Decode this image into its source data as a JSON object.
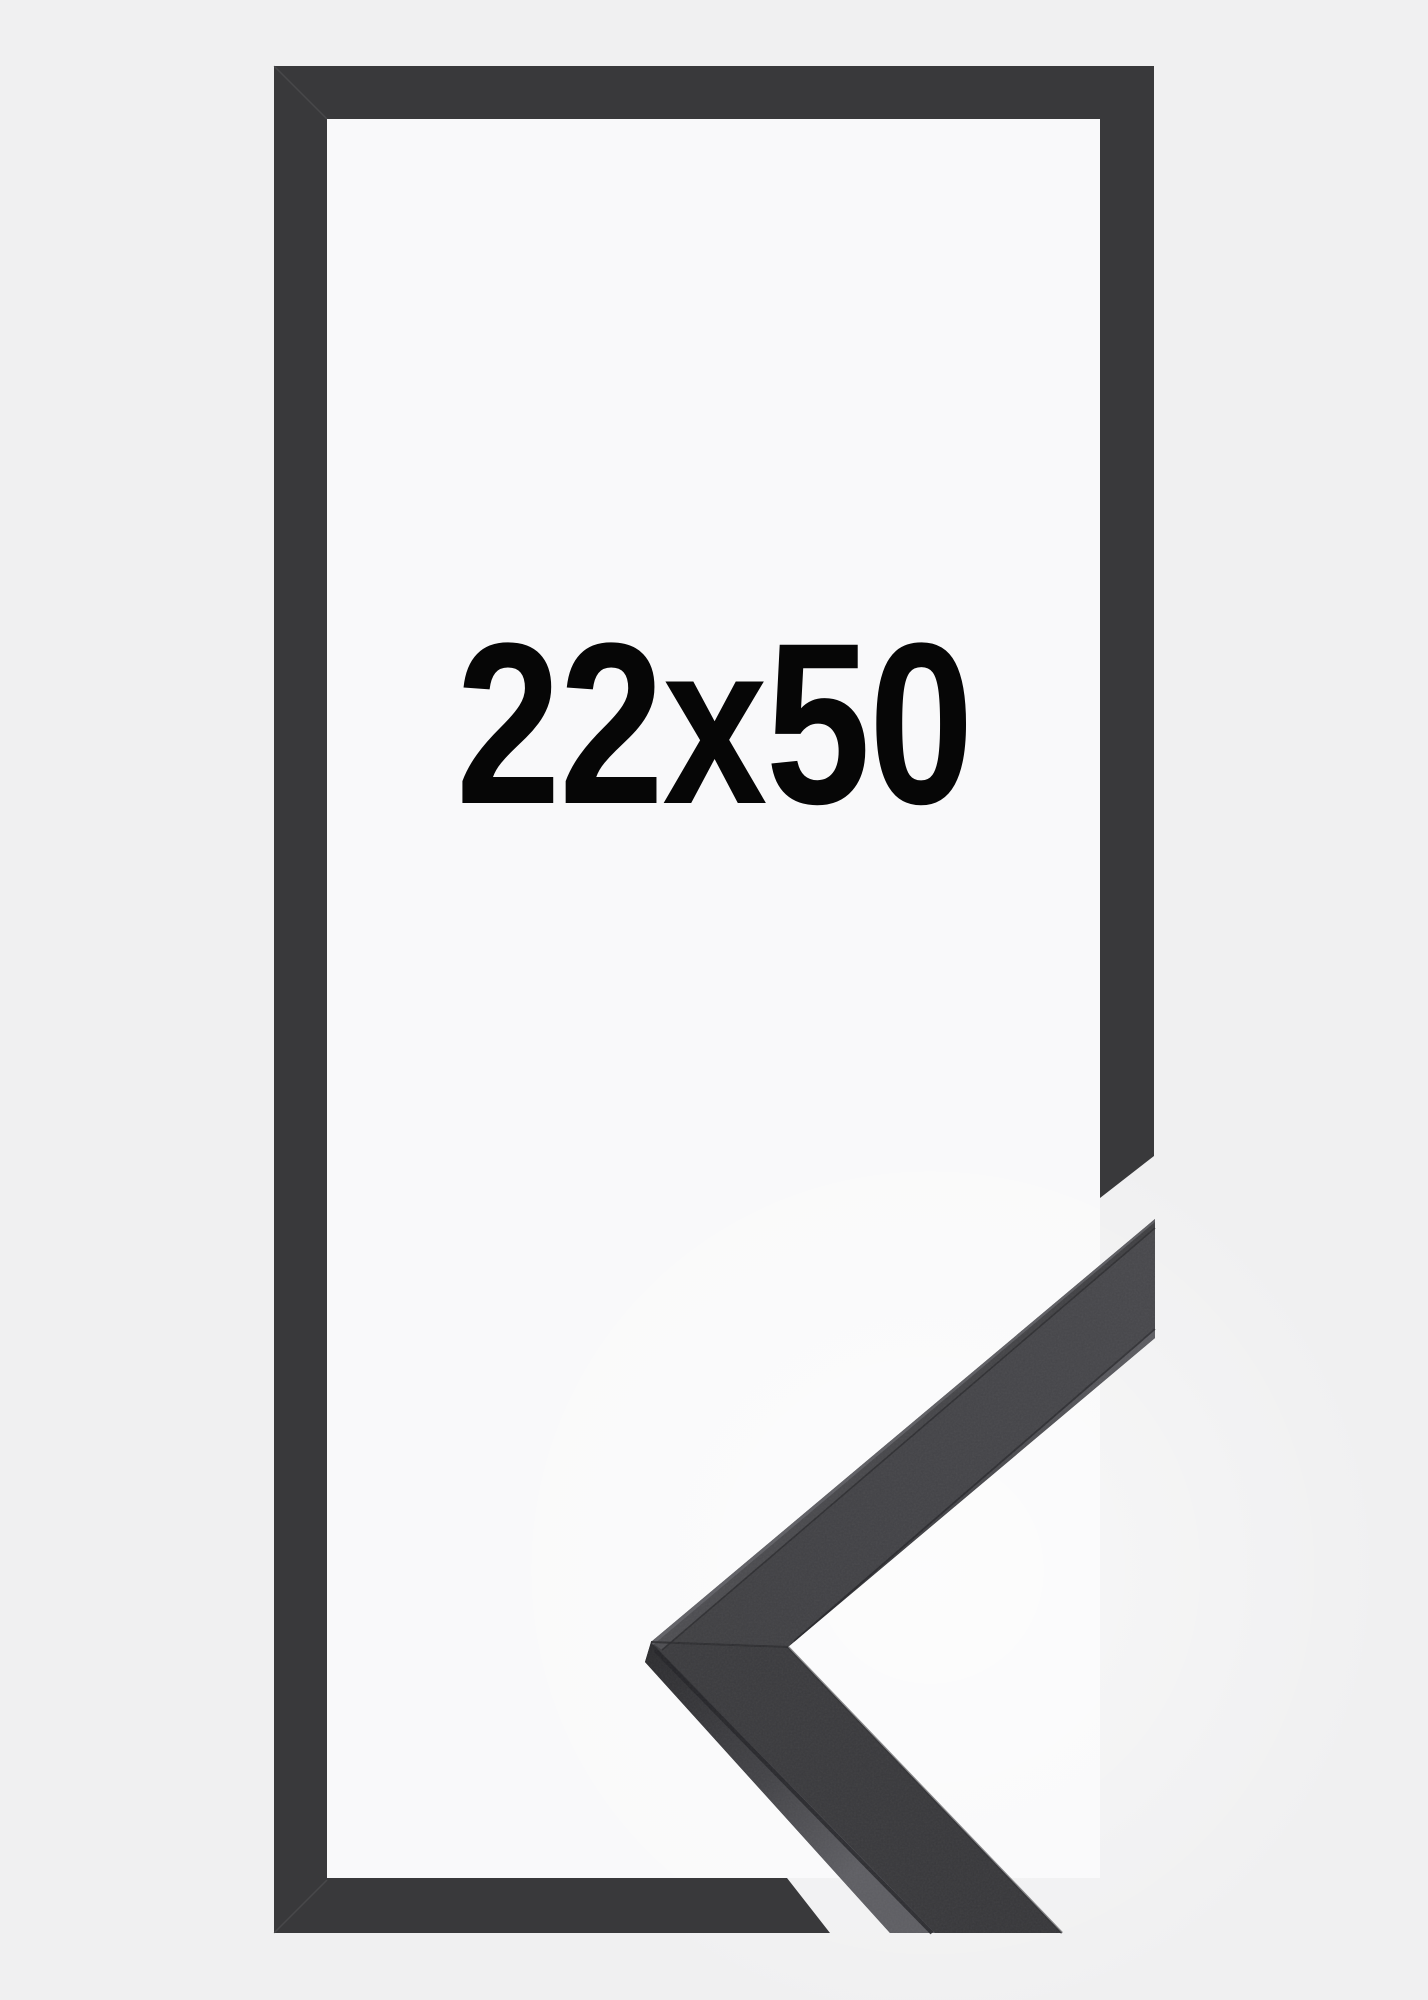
{
  "product": {
    "size_label": "22x50"
  },
  "colors": {
    "bg": "#f0f0f1",
    "interior": "#f9f9fa",
    "bar": "#39393b",
    "miter": "#5a5a5e",
    "text": "#060606",
    "glow": "#ffffff",
    "face_tip_light": "#48484c",
    "face_mid": "#3f3f42",
    "face_low": "#3c3c3f",
    "face_dark": "#37373a",
    "band_top_light": "#4e4e52",
    "band_mid": "#434347",
    "band_dark": "#2c2c2f",
    "band_light": "#5e5e63",
    "edge_highlight": "#6a6a6f",
    "seam": "#232327",
    "seam_soft": "#2b2b2e"
  }
}
